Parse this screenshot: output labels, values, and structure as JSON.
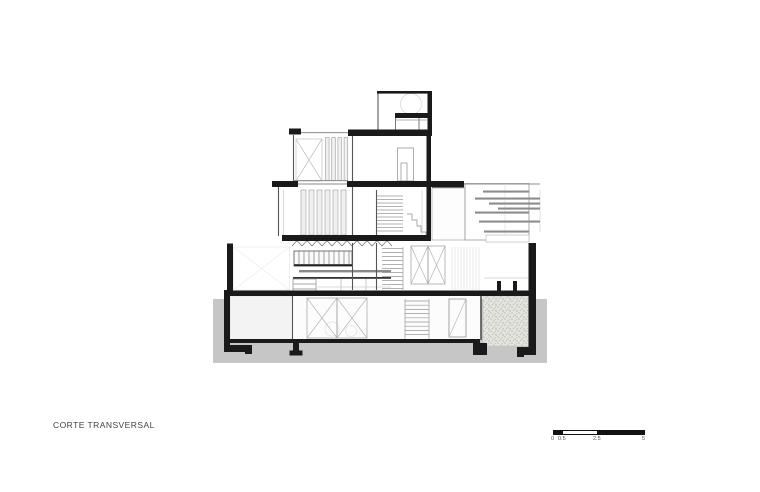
{
  "drawing": {
    "title": "CORTE TRANSVERSAL"
  },
  "scale_bar": {
    "labels": {
      "zero": "0",
      "half": "0.5",
      "mid": "2.5",
      "end": "5"
    }
  },
  "colors": {
    "paper": "#ffffff",
    "ground_poche": "#c6c6c6",
    "cut_black": "#1a1a1a",
    "slat_gray": "#8c8c8c",
    "garden_base": "#e4e4df"
  }
}
